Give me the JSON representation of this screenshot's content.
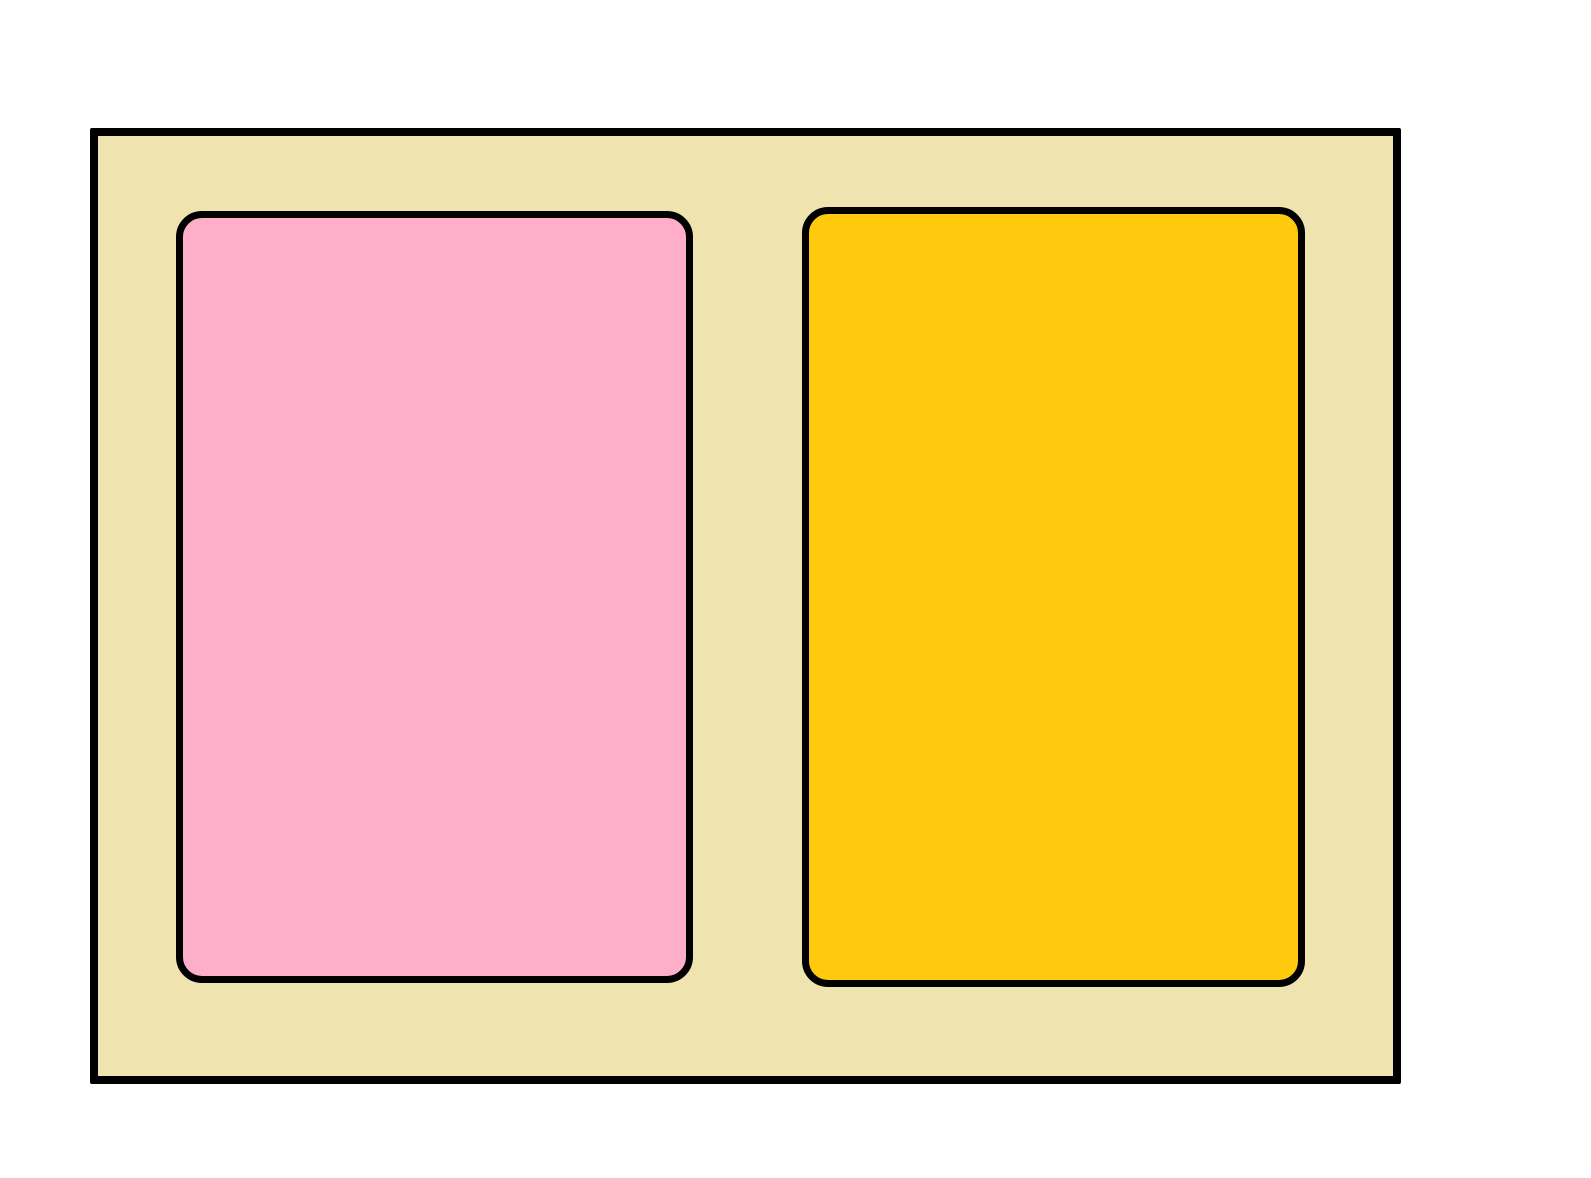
{
  "drawing": {
    "description": "Two rounded rectangles inside an outer rectangle",
    "canvas": {
      "width": 1591,
      "height": 1178,
      "background": "#FFFFFF"
    },
    "board": {
      "name": "outer-board",
      "fill": "#EFE4B0",
      "stroke": "#000000",
      "stroke_width": 8,
      "x": 90,
      "y": 128,
      "width": 1311,
      "height": 956,
      "radius": 2
    },
    "panels": [
      {
        "name": "pink-panel",
        "fill": "#FFAEC9",
        "stroke": "#000000",
        "stroke_width": 7,
        "x": 176,
        "y": 211,
        "width": 517,
        "height": 772,
        "radius": 26
      },
      {
        "name": "gold-panel",
        "fill": "#FFC90E",
        "stroke": "#000000",
        "stroke_width": 7,
        "x": 802,
        "y": 207,
        "width": 503,
        "height": 780,
        "radius": 26
      }
    ]
  }
}
